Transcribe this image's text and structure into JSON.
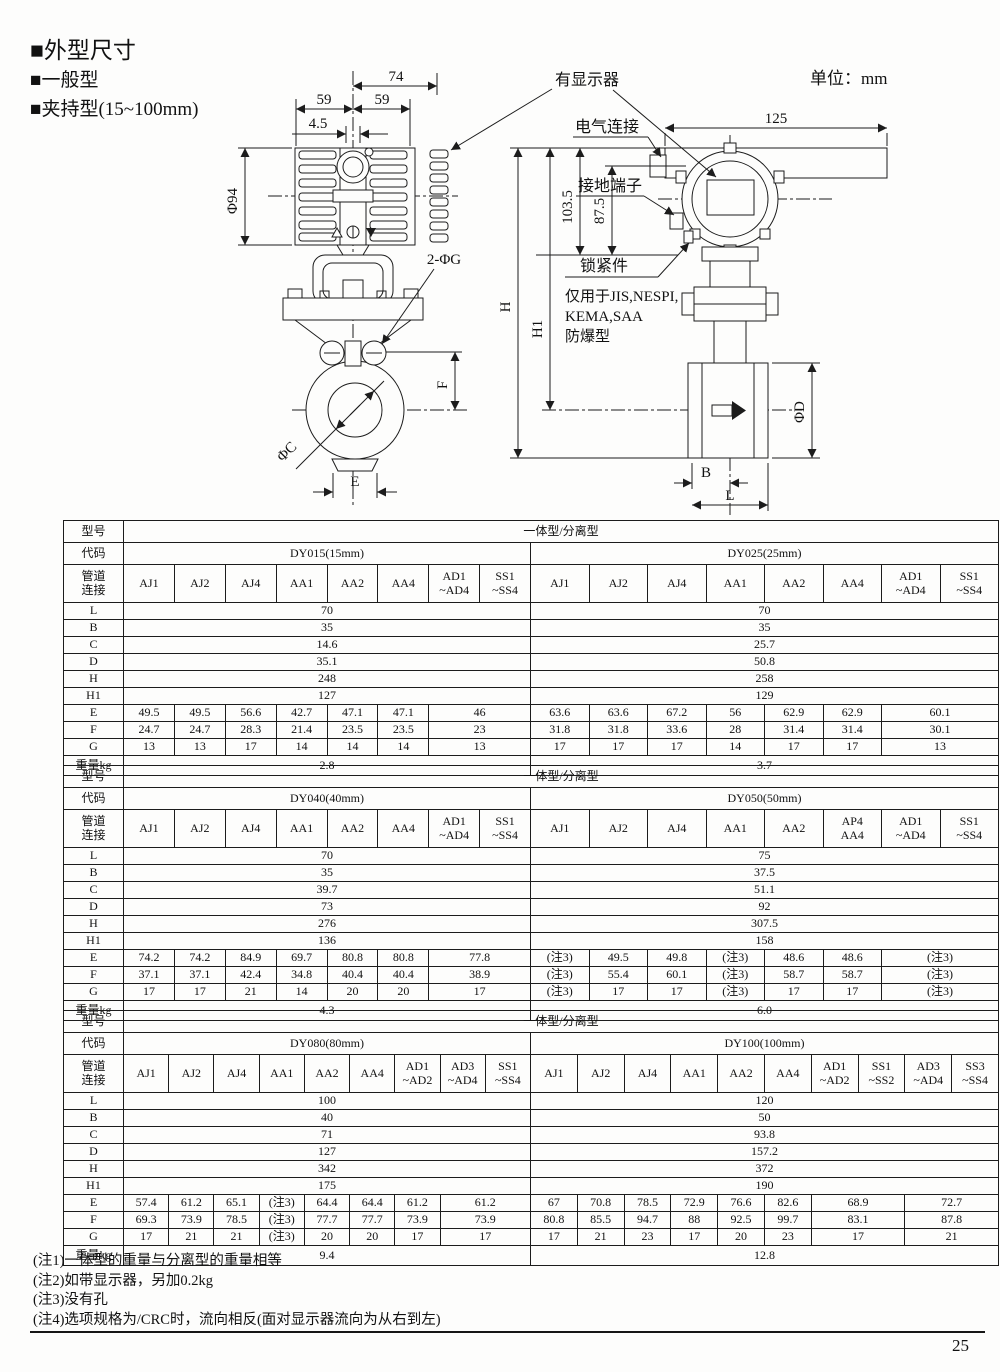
{
  "page": {
    "headings": [
      "■外型尺寸",
      "■一般型",
      "■夹持型(15~100mm)"
    ],
    "unit_label": "单位：mm",
    "page_number": "25"
  },
  "drawing": {
    "front_view": {
      "dim_74": "74",
      "dim_59_left": "59",
      "dim_59_right": "59",
      "dim_4_5": "4.5",
      "dim_phi94": "Φ94",
      "bolt_holes": "2-ΦG",
      "bore": "ΦC",
      "dim_E": "E",
      "dim_F": "F"
    },
    "side_view": {
      "dim_125": "125",
      "dim_103_5": "103.5",
      "dim_87_5": "87.5",
      "dim_H": "H",
      "dim_H1": "H1",
      "dim_phiD": "ΦD",
      "dim_B": "B",
      "dim_L": "L"
    },
    "callouts": {
      "display": "有显示器",
      "electrical": "电气连接",
      "ground": "接地端子",
      "lock": "锁紧件",
      "lock_note_1": "仅用于JIS,NESPI,",
      "lock_note_2": "KEMA,SAA",
      "lock_note_3": "防爆型"
    }
  },
  "table_labels": {
    "model": "型号",
    "model_value": "一体型/分离型",
    "code": "代码",
    "pipe": [
      "管道",
      "连接"
    ],
    "weight": "重量kg",
    "row_labels": [
      "L",
      "B",
      "C",
      "D",
      "H",
      "H1",
      "E",
      "F",
      "G"
    ]
  },
  "dim_tables": [
    {
      "halves": [
        {
          "code": "DY015(15mm)",
          "columns": [
            [
              "AJ1"
            ],
            [
              "AJ2"
            ],
            [
              "AJ4"
            ],
            [
              "AA1"
            ],
            [
              "AA2"
            ],
            [
              "AA4"
            ],
            [
              "AD1",
              "~AD4"
            ],
            [
              "SS1",
              "~SS4"
            ]
          ],
          "shared": {
            "L": "70",
            "B": "35",
            "C": "14.6",
            "D": "35.1",
            "H": "248",
            "H1": "127"
          },
          "E": [
            [
              "49.5",
              1
            ],
            [
              "49.5",
              1
            ],
            [
              "56.6",
              1
            ],
            [
              "42.7",
              1
            ],
            [
              "47.1",
              1
            ],
            [
              "47.1",
              1
            ],
            [
              "46",
              2
            ]
          ],
          "F": [
            [
              "24.7",
              1
            ],
            [
              "24.7",
              1
            ],
            [
              "28.3",
              1
            ],
            [
              "21.4",
              1
            ],
            [
              "23.5",
              1
            ],
            [
              "23.5",
              1
            ],
            [
              "23",
              2
            ]
          ],
          "G": [
            [
              "13",
              1
            ],
            [
              "13",
              1
            ],
            [
              "17",
              1
            ],
            [
              "14",
              1
            ],
            [
              "14",
              1
            ],
            [
              "14",
              1
            ],
            [
              "13",
              2
            ]
          ],
          "weight": "2.8"
        },
        {
          "code": "DY025(25mm)",
          "columns": [
            [
              "AJ1"
            ],
            [
              "AJ2"
            ],
            [
              "AJ4"
            ],
            [
              "AA1"
            ],
            [
              "AA2"
            ],
            [
              "AA4"
            ],
            [
              "AD1",
              "~AD4"
            ],
            [
              "SS1",
              "~SS4"
            ]
          ],
          "shared": {
            "L": "70",
            "B": "35",
            "C": "25.7",
            "D": "50.8",
            "H": "258",
            "H1": "129"
          },
          "E": [
            [
              "63.6",
              1
            ],
            [
              "63.6",
              1
            ],
            [
              "67.2",
              1
            ],
            [
              "56",
              1
            ],
            [
              "62.9",
              1
            ],
            [
              "62.9",
              1
            ],
            [
              "60.1",
              2
            ]
          ],
          "F": [
            [
              "31.8",
              1
            ],
            [
              "31.8",
              1
            ],
            [
              "33.6",
              1
            ],
            [
              "28",
              1
            ],
            [
              "31.4",
              1
            ],
            [
              "31.4",
              1
            ],
            [
              "30.1",
              2
            ]
          ],
          "G": [
            [
              "17",
              1
            ],
            [
              "17",
              1
            ],
            [
              "17",
              1
            ],
            [
              "14",
              1
            ],
            [
              "17",
              1
            ],
            [
              "17",
              1
            ],
            [
              "13",
              2
            ]
          ],
          "weight": "3.7"
        }
      ]
    },
    {
      "halves": [
        {
          "code": "DY040(40mm)",
          "columns": [
            [
              "AJ1"
            ],
            [
              "AJ2"
            ],
            [
              "AJ4"
            ],
            [
              "AA1"
            ],
            [
              "AA2"
            ],
            [
              "AA4"
            ],
            [
              "AD1",
              "~AD4"
            ],
            [
              "SS1",
              "~SS4"
            ]
          ],
          "shared": {
            "L": "70",
            "B": "35",
            "C": "39.7",
            "D": "73",
            "H": "276",
            "H1": "136"
          },
          "E": [
            [
              "74.2",
              1
            ],
            [
              "74.2",
              1
            ],
            [
              "84.9",
              1
            ],
            [
              "69.7",
              1
            ],
            [
              "80.8",
              1
            ],
            [
              "80.8",
              1
            ],
            [
              "77.8",
              2
            ]
          ],
          "F": [
            [
              "37.1",
              1
            ],
            [
              "37.1",
              1
            ],
            [
              "42.4",
              1
            ],
            [
              "34.8",
              1
            ],
            [
              "40.4",
              1
            ],
            [
              "40.4",
              1
            ],
            [
              "38.9",
              2
            ]
          ],
          "G": [
            [
              "17",
              1
            ],
            [
              "17",
              1
            ],
            [
              "21",
              1
            ],
            [
              "14",
              1
            ],
            [
              "20",
              1
            ],
            [
              "20",
              1
            ],
            [
              "17",
              2
            ]
          ],
          "weight": "4.3"
        },
        {
          "code": "DY050(50mm)",
          "columns": [
            [
              "AJ1"
            ],
            [
              "AJ2"
            ],
            [
              "AJ4"
            ],
            [
              "AA1"
            ],
            [
              "AA2"
            ],
            [
              "AP4",
              "AA4"
            ],
            [
              "AD1",
              "~AD4"
            ],
            [
              "SS1",
              "~SS4"
            ]
          ],
          "shared": {
            "L": "75",
            "B": "37.5",
            "C": "51.1",
            "D": "92",
            "H": "307.5",
            "H1": "158"
          },
          "E": [
            [
              "(注3)",
              1
            ],
            [
              "49.5",
              1
            ],
            [
              "49.8",
              1
            ],
            [
              "(注3)",
              1
            ],
            [
              "48.6",
              1
            ],
            [
              "48.6",
              1
            ],
            [
              "(注3)",
              2
            ]
          ],
          "F": [
            [
              "(注3)",
              1
            ],
            [
              "55.4",
              1
            ],
            [
              "60.1",
              1
            ],
            [
              "(注3)",
              1
            ],
            [
              "58.7",
              1
            ],
            [
              "58.7",
              1
            ],
            [
              "(注3)",
              2
            ]
          ],
          "G": [
            [
              "(注3)",
              1
            ],
            [
              "17",
              1
            ],
            [
              "17",
              1
            ],
            [
              "(注3)",
              1
            ],
            [
              "17",
              1
            ],
            [
              "17",
              1
            ],
            [
              "(注3)",
              2
            ]
          ],
          "weight": "6.0"
        }
      ]
    },
    {
      "halves": [
        {
          "code": "DY080(80mm)",
          "columns": [
            [
              "AJ1"
            ],
            [
              "AJ2"
            ],
            [
              "AJ4"
            ],
            [
              "AA1"
            ],
            [
              "AA2"
            ],
            [
              "AA4"
            ],
            [
              "AD1",
              "~AD2"
            ],
            [
              "AD3",
              "~AD4"
            ],
            [
              "SS1",
              "~SS4"
            ]
          ],
          "shared": {
            "L": "100",
            "B": "40",
            "C": "71",
            "D": "127",
            "H": "342",
            "H1": "175"
          },
          "E": [
            [
              "57.4",
              1
            ],
            [
              "61.2",
              1
            ],
            [
              "65.1",
              1
            ],
            [
              "(注3)",
              1
            ],
            [
              "64.4",
              1
            ],
            [
              "64.4",
              1
            ],
            [
              "61.2",
              1
            ],
            [
              "61.2",
              2
            ]
          ],
          "F": [
            [
              "69.3",
              1
            ],
            [
              "73.9",
              1
            ],
            [
              "78.5",
              1
            ],
            [
              "(注3)",
              1
            ],
            [
              "77.7",
              1
            ],
            [
              "77.7",
              1
            ],
            [
              "73.9",
              1
            ],
            [
              "73.9",
              2
            ]
          ],
          "G": [
            [
              "17",
              1
            ],
            [
              "21",
              1
            ],
            [
              "21",
              1
            ],
            [
              "(注3)",
              1
            ],
            [
              "20",
              1
            ],
            [
              "20",
              1
            ],
            [
              "17",
              1
            ],
            [
              "17",
              2
            ]
          ],
          "weight": "9.4"
        },
        {
          "code": "DY100(100mm)",
          "columns": [
            [
              "AJ1"
            ],
            [
              "AJ2"
            ],
            [
              "AJ4"
            ],
            [
              "AA1"
            ],
            [
              "AA2"
            ],
            [
              "AA4"
            ],
            [
              "AD1",
              "~AD2"
            ],
            [
              "SS1",
              "~SS2"
            ],
            [
              "AD3",
              "~AD4"
            ],
            [
              "SS3",
              "~SS4"
            ]
          ],
          "shared": {
            "L": "120",
            "B": "50",
            "C": "93.8",
            "D": "157.2",
            "H": "372",
            "H1": "190"
          },
          "E": [
            [
              "67",
              1
            ],
            [
              "70.8",
              1
            ],
            [
              "78.5",
              1
            ],
            [
              "72.9",
              1
            ],
            [
              "76.6",
              1
            ],
            [
              "82.6",
              1
            ],
            [
              "68.9",
              2
            ],
            [
              "72.7",
              2
            ]
          ],
          "F": [
            [
              "80.8",
              1
            ],
            [
              "85.5",
              1
            ],
            [
              "94.7",
              1
            ],
            [
              "88",
              1
            ],
            [
              "92.5",
              1
            ],
            [
              "99.7",
              1
            ],
            [
              "83.1",
              2
            ],
            [
              "87.8",
              2
            ]
          ],
          "G": [
            [
              "17",
              1
            ],
            [
              "21",
              1
            ],
            [
              "23",
              1
            ],
            [
              "17",
              1
            ],
            [
              "20",
              1
            ],
            [
              "23",
              1
            ],
            [
              "17",
              2
            ],
            [
              "21",
              2
            ]
          ],
          "weight": "12.8"
        }
      ]
    }
  ],
  "notes": [
    "(注1)一体型的重量与分离型的重量相等",
    "(注2)如带显示器，另加0.2kg",
    "(注3)没有孔",
    "(注4)选项规格为/CRC时，流向相反(面对显示器流向为从右到左)"
  ]
}
